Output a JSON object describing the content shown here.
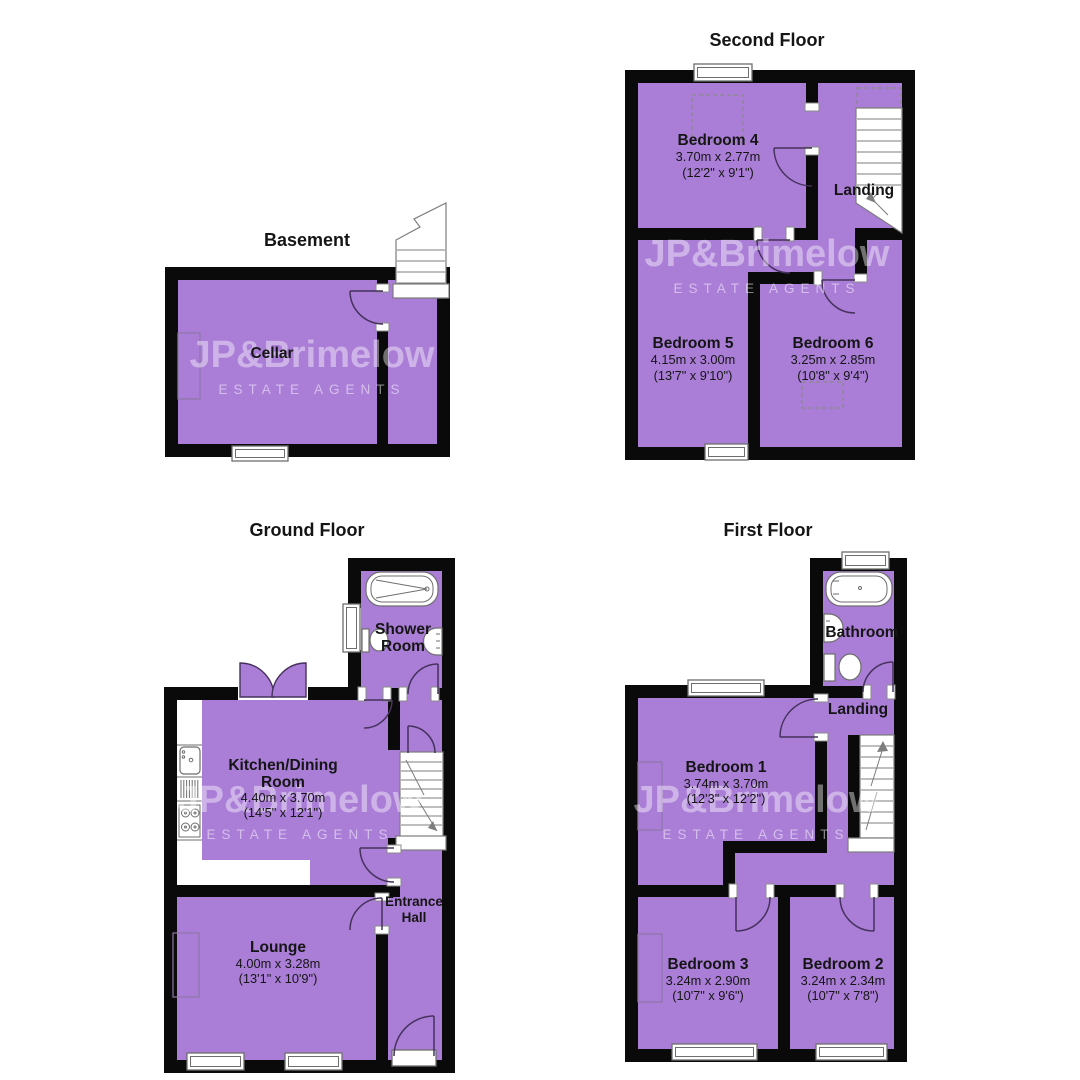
{
  "watermark": {
    "brand": "JP&Brimelow",
    "tagline": "ESTATE AGENTS"
  },
  "colors": {
    "room_fill": "#aa7dd7",
    "wall": "#0a0a0a",
    "watermark_text": "#ffffff"
  },
  "floors": {
    "basement": {
      "title": "Basement",
      "rooms": {
        "cellar": {
          "name": "Cellar"
        }
      }
    },
    "second": {
      "title": "Second Floor",
      "rooms": {
        "bedroom4": {
          "name": "Bedroom 4",
          "dims_m": "3.70m x 2.77m",
          "dims_ft": "(12'2\" x 9'1\")"
        },
        "landing": {
          "name": "Landing"
        },
        "bedroom5": {
          "name": "Bedroom 5",
          "dims_m": "4.15m x 3.00m",
          "dims_ft": "(13'7\" x 9'10\")"
        },
        "bedroom6": {
          "name": "Bedroom 6",
          "dims_m": "3.25m x 2.85m",
          "dims_ft": "(10'8\" x 9'4\")"
        }
      }
    },
    "ground": {
      "title": "Ground Floor",
      "rooms": {
        "shower_room": {
          "name_line1": "Shower",
          "name_line2": "Room"
        },
        "kitchen": {
          "name_line1": "Kitchen/Dining",
          "name_line2": "Room",
          "dims_m": "4.40m x 3.70m",
          "dims_ft": "(14'5\" x 12'1\")"
        },
        "entrance_hall": {
          "name_line1": "Entrance",
          "name_line2": "Hall"
        },
        "lounge": {
          "name": "Lounge",
          "dims_m": "4.00m x 3.28m",
          "dims_ft": "(13'1\" x 10'9\")"
        }
      }
    },
    "first": {
      "title": "First Floor",
      "rooms": {
        "bathroom": {
          "name": "Bathroom"
        },
        "landing": {
          "name": "Landing"
        },
        "bedroom1": {
          "name": "Bedroom 1",
          "dims_m": "3.74m x 3.70m",
          "dims_ft": "(12'3\" x 12'2\")"
        },
        "bedroom3": {
          "name": "Bedroom 3",
          "dims_m": "3.24m x 2.90m",
          "dims_ft": "(10'7\" x 9'6\")"
        },
        "bedroom2": {
          "name": "Bedroom 2",
          "dims_m": "3.24m x 2.34m",
          "dims_ft": "(10'7\" x 7'8\")"
        }
      }
    }
  }
}
